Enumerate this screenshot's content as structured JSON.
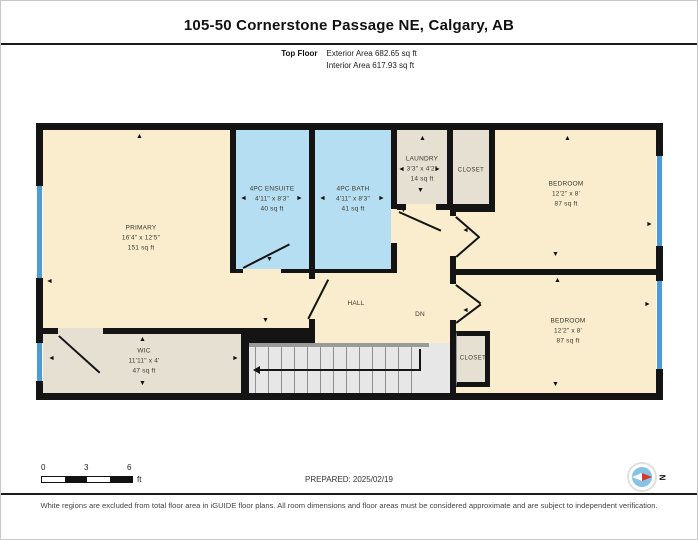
{
  "header": {
    "title": "105-50 Cornerstone Passage NE, Calgary, AB",
    "floor_label": "Top Floor",
    "exterior_area": "Exterior Area 682.65 sq ft",
    "interior_area": "Interior Area 617.93 sq ft"
  },
  "rooms": {
    "primary": {
      "name": "PRIMARY",
      "dims": "16'4\" x 12'5\"",
      "area": "151 sq ft"
    },
    "wic": {
      "name": "WIC",
      "dims": "11'11\" x 4'",
      "area": "47 sq ft"
    },
    "ensuite": {
      "name": "4PC ENSUITE",
      "dims": "4'11\" x 8'3\"",
      "area": "40 sq ft"
    },
    "bath": {
      "name": "4PC BATH",
      "dims": "4'11\" x 8'3\"",
      "area": "41 sq ft"
    },
    "laundry": {
      "name": "LAUNDRY",
      "dims": "3'3\" x 4'2\"",
      "area": "14 sq ft"
    },
    "closet_top": {
      "name": "CLOSET"
    },
    "closet_bottom": {
      "name": "CLOSET"
    },
    "bedroom_top": {
      "name": "BEDROOM",
      "dims": "12'2\" x 8'",
      "area": "87 sq ft"
    },
    "bedroom_bottom": {
      "name": "BEDROOM",
      "dims": "12'2\" x 8'",
      "area": "87 sq ft"
    },
    "hall": {
      "name": "HALL"
    },
    "stairs": {
      "label": "DN"
    }
  },
  "scale_bar": {
    "start": "0",
    "mid": "3",
    "end": "6",
    "unit": "ft"
  },
  "footer": {
    "prepared": "PREPARED: 2025/02/19",
    "disclaimer": "White regions are excluded from total floor area in iGUIDE floor plans. All room dimensions and floor areas must be considered approximate and are subject to independent verification.",
    "compass_letter": "N"
  },
  "icons": {
    "arrow_up": "▲",
    "arrow_down": "▼",
    "arrow_left": "◄",
    "arrow_right": "►"
  },
  "colors": {
    "wall": "#141414",
    "room_cream": "#FAEDCD",
    "room_blue": "#B5DEF2",
    "room_tan": "#E6E0D3",
    "stairs_gray": "#E7E7E7",
    "window_blue": "#4D9BD3",
    "compass_red": "#D8372B",
    "compass_blue": "#85C3E6"
  }
}
